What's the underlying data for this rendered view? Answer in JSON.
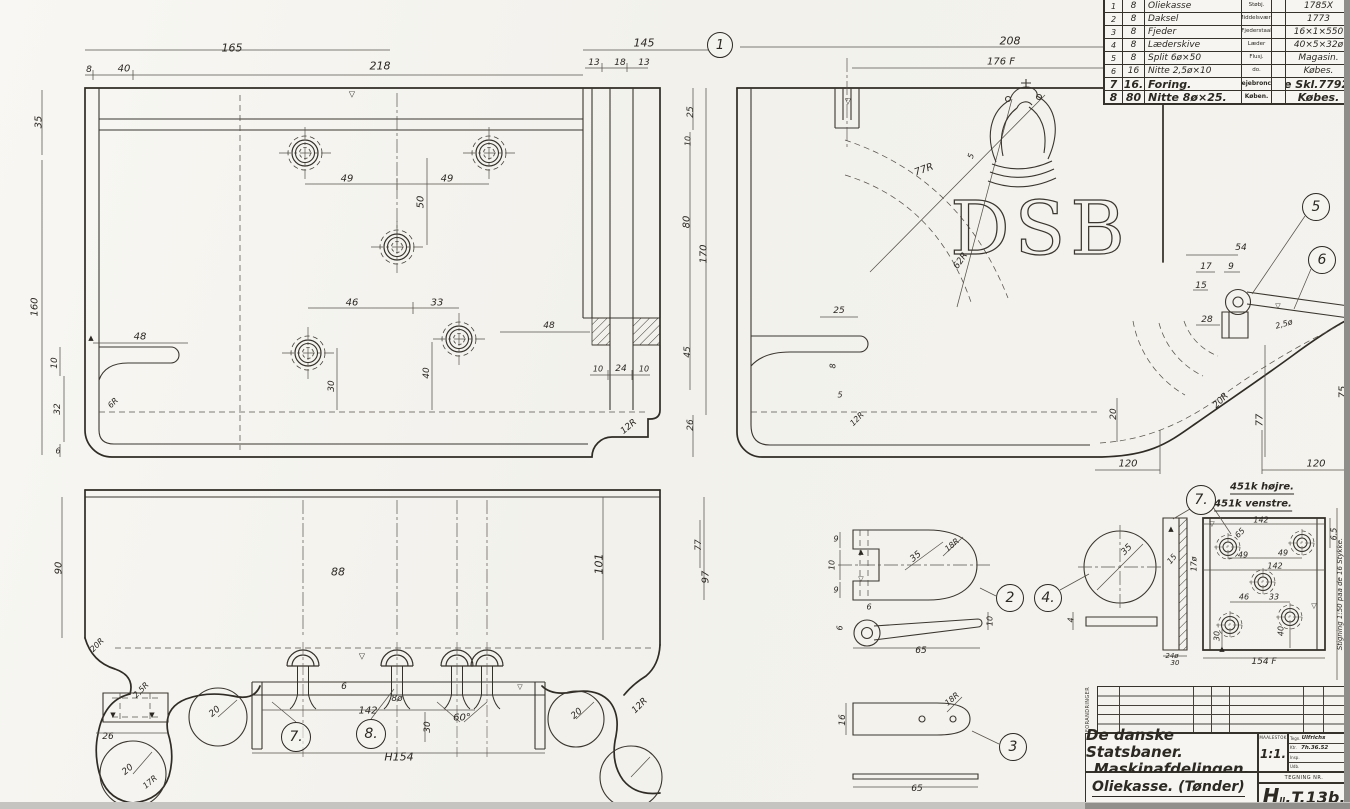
{
  "colors": {
    "ink": "#2c2923",
    "paper": "#f4f3ef",
    "scan_edge_right": "#8f8d89",
    "scan_edge_bottom": "#c6c4c0"
  },
  "emblem": {
    "letters": "DSB"
  },
  "parts_table": {
    "rows": [
      {
        "no": "1",
        "qty": "8",
        "name": "Oliekasse",
        "material": "Støbj.",
        "note": "1785X"
      },
      {
        "no": "2",
        "qty": "8",
        "name": "Daksel",
        "material": "Middelsvære",
        "note": "1773"
      },
      {
        "no": "3",
        "qty": "8",
        "name": "Fjeder",
        "material": "Fjederstaal",
        "note": "16×1×550"
      },
      {
        "no": "4",
        "qty": "8",
        "name": "Læderskive",
        "material": "Læder",
        "note": "40×5×32ø"
      },
      {
        "no": "5",
        "qty": "8",
        "name": "Split 6ø×50",
        "material": "Flusj.",
        "note": "Magasin."
      },
      {
        "no": "6",
        "qty": "16",
        "name": "Nitte 2,5ø×10",
        "material": "do.",
        "note": "Købes."
      },
      {
        "no": "7",
        "qty": "16.",
        "name": "Foring.",
        "material": "Lejebronce",
        "note": "Se Skl.77926."
      },
      {
        "no": "8",
        "qty": "80",
        "name": "Nitte 8ø×25.",
        "material": "Køben.",
        "note": "Købes."
      }
    ]
  },
  "title_block": {
    "revisions_label": "FORANDRINGER",
    "company_line1": "De danske Statsbaner.",
    "company_line2": "Maskinafdelingen.",
    "drawing_title": "Oliekasse.  (Tønder)",
    "drawing_subtitle": "12.86.b.F.",
    "scale_label": "MAALESTOK",
    "scale_value": "1:1.",
    "sign_rows": [
      {
        "label": "Tegn.",
        "value": "Ulfrichs"
      },
      {
        "label": "Ktr.",
        "value": "7h.36.52"
      },
      {
        "label": "Insp.",
        "value": ""
      },
      {
        "label": "Udb.",
        "value": ""
      }
    ],
    "number_label": "TEGNING NR.",
    "number_prefix": "H",
    "number_sub": "II",
    "number_rest": ".T.13b."
  },
  "callouts": [
    {
      "n": "1",
      "x": 720,
      "y": 45,
      "d": 26
    },
    {
      "n": "2",
      "x": 1010,
      "y": 598,
      "d": 28
    },
    {
      "n": "3",
      "x": 1013,
      "y": 747,
      "d": 28
    },
    {
      "n": "4.",
      "x": 1048,
      "y": 598,
      "d": 28
    },
    {
      "n": "5",
      "x": 1316,
      "y": 207,
      "d": 28
    },
    {
      "n": "6",
      "x": 1322,
      "y": 260,
      "d": 28
    },
    {
      "n": "7.",
      "x": 296,
      "y": 737,
      "d": 30
    },
    {
      "n": "8.",
      "x": 371,
      "y": 734,
      "d": 30
    },
    {
      "n": "7.",
      "x": 1201,
      "y": 500,
      "d": 30
    }
  ],
  "dim_labels": [
    {
      "t": "165",
      "x": 232,
      "y": 48,
      "s": 11
    },
    {
      "t": "8",
      "x": 89,
      "y": 70,
      "s": 9
    },
    {
      "t": "40",
      "x": 124,
      "y": 69
    },
    {
      "t": "218",
      "x": 380,
      "y": 66,
      "s": 11
    },
    {
      "t": "145",
      "x": 644,
      "y": 43,
      "s": 11
    },
    {
      "t": "13",
      "x": 594,
      "y": 63,
      "s": 9
    },
    {
      "t": "18",
      "x": 620,
      "y": 63,
      "s": 9
    },
    {
      "t": "13",
      "x": 644,
      "y": 63,
      "s": 9
    },
    {
      "t": "▽",
      "x": 352,
      "y": 94,
      "s": 8
    },
    {
      "t": "35",
      "x": 39,
      "y": 122,
      "r": -90
    },
    {
      "t": "160",
      "x": 35,
      "y": 307,
      "r": -90
    },
    {
      "t": "49",
      "x": 347,
      "y": 179
    },
    {
      "t": "49",
      "x": 447,
      "y": 179
    },
    {
      "t": "50",
      "x": 421,
      "y": 202,
      "r": -90
    },
    {
      "t": "46",
      "x": 352,
      "y": 303
    },
    {
      "t": "33",
      "x": 437,
      "y": 303
    },
    {
      "t": "30",
      "x": 332,
      "y": 386,
      "r": -90,
      "s": 9
    },
    {
      "t": "40",
      "x": 427,
      "y": 373,
      "r": -90,
      "s": 9
    },
    {
      "t": "▲",
      "x": 91,
      "y": 338,
      "s": 7
    },
    {
      "t": "48",
      "x": 140,
      "y": 337
    },
    {
      "t": "10",
      "x": 55,
      "y": 363,
      "r": -90,
      "s": 9
    },
    {
      "t": "32",
      "x": 58,
      "y": 409,
      "r": -90,
      "s": 9
    },
    {
      "t": "6",
      "x": 58,
      "y": 451,
      "s": 8
    },
    {
      "t": "6R",
      "x": 113,
      "y": 403,
      "r": -45,
      "s": 8
    },
    {
      "t": "48",
      "x": 549,
      "y": 326,
      "s": 9
    },
    {
      "t": "10",
      "x": 598,
      "y": 369,
      "s": 8
    },
    {
      "t": "24",
      "x": 621,
      "y": 369,
      "s": 9
    },
    {
      "t": "10",
      "x": 644,
      "y": 369,
      "s": 8
    },
    {
      "t": "12R",
      "x": 629,
      "y": 427,
      "r": -40,
      "s": 9
    },
    {
      "t": "25",
      "x": 691,
      "y": 112,
      "r": -90,
      "s": 9
    },
    {
      "t": "10",
      "x": 688,
      "y": 141,
      "r": -90,
      "s": 8
    },
    {
      "t": "80",
      "x": 687,
      "y": 222,
      "r": -90
    },
    {
      "t": "170",
      "x": 704,
      "y": 254,
      "r": -90
    },
    {
      "t": "45",
      "x": 688,
      "y": 352,
      "r": -90,
      "s": 9
    },
    {
      "t": "26",
      "x": 691,
      "y": 425,
      "r": -90,
      "s": 9
    },
    {
      "t": "208",
      "x": 1010,
      "y": 41,
      "s": 11
    },
    {
      "t": "176 F",
      "x": 1001,
      "y": 62
    },
    {
      "t": "▽",
      "x": 848,
      "y": 101,
      "s": 8
    },
    {
      "t": "77R",
      "x": 924,
      "y": 170,
      "r": -20
    },
    {
      "t": "5",
      "x": 971,
      "y": 156,
      "r": -70,
      "s": 8
    },
    {
      "t": "62R",
      "x": 961,
      "y": 261,
      "r": -55,
      "s": 9
    },
    {
      "t": "25",
      "x": 839,
      "y": 311,
      "s": 9
    },
    {
      "t": "8",
      "x": 833,
      "y": 366,
      "r": -90,
      "s": 8
    },
    {
      "t": "5",
      "x": 840,
      "y": 395,
      "s": 8
    },
    {
      "t": "12R",
      "x": 857,
      "y": 419,
      "r": -45,
      "s": 8
    },
    {
      "t": "54",
      "x": 1241,
      "y": 248,
      "s": 9
    },
    {
      "t": "17",
      "x": 1206,
      "y": 267,
      "s": 9
    },
    {
      "t": "9",
      "x": 1231,
      "y": 267,
      "s": 9
    },
    {
      "t": "15",
      "x": 1201,
      "y": 286,
      "s": 9
    },
    {
      "t": "28",
      "x": 1207,
      "y": 320,
      "s": 9
    },
    {
      "t": "▽",
      "x": 1278,
      "y": 306,
      "s": 7
    },
    {
      "t": "2,5ø",
      "x": 1284,
      "y": 324,
      "r": -15,
      "s": 8
    },
    {
      "t": "20",
      "x": 1114,
      "y": 414,
      "r": -90,
      "s": 9
    },
    {
      "t": "20R",
      "x": 1221,
      "y": 401,
      "r": -45,
      "s": 9
    },
    {
      "t": "77",
      "x": 1260,
      "y": 420,
      "r": -90
    },
    {
      "t": "75",
      "x": 1343,
      "y": 392,
      "r": -90
    },
    {
      "t": "120",
      "x": 1128,
      "y": 464
    },
    {
      "t": "120",
      "x": 1316,
      "y": 464
    },
    {
      "t": "88",
      "x": 338,
      "y": 572,
      "s": 11
    },
    {
      "t": "101",
      "x": 599,
      "y": 564,
      "r": -90,
      "s": 11
    },
    {
      "t": "90",
      "x": 59,
      "y": 568,
      "r": -90
    },
    {
      "t": "97",
      "x": 706,
      "y": 577,
      "r": -90
    },
    {
      "t": "77",
      "x": 699,
      "y": 545,
      "r": -90,
      "s": 9
    },
    {
      "t": "20R",
      "x": 97,
      "y": 645,
      "r": -45,
      "s": 8
    },
    {
      "t": "▼",
      "x": 113,
      "y": 715,
      "s": 7
    },
    {
      "t": "▼",
      "x": 152,
      "y": 715,
      "s": 7
    },
    {
      "t": "26",
      "x": 108,
      "y": 737,
      "s": 9
    },
    {
      "t": "2,5R",
      "x": 141,
      "y": 690,
      "r": -45,
      "s": 8
    },
    {
      "t": "20",
      "x": 128,
      "y": 770,
      "r": -40,
      "s": 9
    },
    {
      "t": "17R",
      "x": 150,
      "y": 782,
      "r": -40,
      "s": 8
    },
    {
      "t": "20",
      "x": 215,
      "y": 712,
      "r": -40,
      "s": 9
    },
    {
      "t": "20",
      "x": 577,
      "y": 714,
      "r": -40,
      "s": 9
    },
    {
      "t": "12R",
      "x": 640,
      "y": 706,
      "r": -45,
      "s": 9
    },
    {
      "t": "▽",
      "x": 362,
      "y": 656,
      "s": 8
    },
    {
      "t": "▽",
      "x": 520,
      "y": 687,
      "s": 7
    },
    {
      "t": "6",
      "x": 344,
      "y": 687,
      "s": 9
    },
    {
      "t": "8ø",
      "x": 397,
      "y": 699,
      "s": 9
    },
    {
      "t": "142",
      "x": 368,
      "y": 711
    },
    {
      "t": "60°",
      "x": 462,
      "y": 718
    },
    {
      "t": "30",
      "x": 428,
      "y": 727,
      "r": -90,
      "s": 9
    },
    {
      "t": "H154",
      "x": 399,
      "y": 757,
      "s": 11
    },
    {
      "t": "9",
      "x": 836,
      "y": 539,
      "s": 8
    },
    {
      "t": "10",
      "x": 832,
      "y": 565,
      "r": -90,
      "s": 8
    },
    {
      "t": "9",
      "x": 836,
      "y": 590,
      "s": 8
    },
    {
      "t": "▲",
      "x": 861,
      "y": 552,
      "s": 7
    },
    {
      "t": "▽",
      "x": 861,
      "y": 579,
      "s": 7
    },
    {
      "t": "35",
      "x": 916,
      "y": 557,
      "r": -40,
      "s": 9
    },
    {
      "t": "18R",
      "x": 952,
      "y": 545,
      "r": -40,
      "s": 8
    },
    {
      "t": "6",
      "x": 869,
      "y": 607,
      "s": 8
    },
    {
      "t": "6",
      "x": 840,
      "y": 628,
      "r": -90,
      "s": 8
    },
    {
      "t": "65",
      "x": 921,
      "y": 651,
      "s": 9
    },
    {
      "t": "10",
      "x": 990,
      "y": 621,
      "r": -90,
      "s": 8
    },
    {
      "t": "35",
      "x": 1127,
      "y": 550,
      "r": -45,
      "s": 9
    },
    {
      "t": "4",
      "x": 1071,
      "y": 620,
      "r": -90,
      "s": 8
    },
    {
      "t": "18R",
      "x": 952,
      "y": 699,
      "r": -40,
      "s": 8
    },
    {
      "t": "16",
      "x": 843,
      "y": 720,
      "r": -90,
      "s": 9
    },
    {
      "t": "65",
      "x": 917,
      "y": 789,
      "s": 9
    },
    {
      "t": "451k højre.",
      "x": 1262,
      "y": 488,
      "s": 10,
      "c": "hand-u"
    },
    {
      "t": "451k venstre.",
      "x": 1253,
      "y": 505,
      "s": 10,
      "c": "hand-u"
    },
    {
      "t": "142",
      "x": 1261,
      "y": 520,
      "s": 8
    },
    {
      "t": "65",
      "x": 1240,
      "y": 533,
      "r": -45,
      "s": 8
    },
    {
      "t": "6.5",
      "x": 1334,
      "y": 534,
      "r": -90,
      "s": 8
    },
    {
      "t": "49",
      "x": 1243,
      "y": 555,
      "s": 8
    },
    {
      "t": "49",
      "x": 1283,
      "y": 553,
      "s": 8
    },
    {
      "t": "142",
      "x": 1275,
      "y": 566,
      "s": 8
    },
    {
      "t": "46",
      "x": 1244,
      "y": 597,
      "s": 8
    },
    {
      "t": "33",
      "x": 1274,
      "y": 597,
      "s": 8
    },
    {
      "t": "40",
      "x": 1281,
      "y": 631,
      "r": -90,
      "s": 8
    },
    {
      "t": "30",
      "x": 1217,
      "y": 636,
      "r": -90,
      "s": 8
    },
    {
      "t": "154 F",
      "x": 1264,
      "y": 662,
      "s": 9
    },
    {
      "t": "15",
      "x": 1172,
      "y": 559,
      "r": -50,
      "s": 8
    },
    {
      "t": "17ø",
      "x": 1194,
      "y": 564,
      "r": -90,
      "s": 8
    },
    {
      "t": "24ø",
      "x": 1172,
      "y": 656,
      "s": 7
    },
    {
      "t": "30",
      "x": 1175,
      "y": 663,
      "s": 7
    },
    {
      "t": "▽",
      "x": 1212,
      "y": 524,
      "s": 7
    },
    {
      "t": "▲",
      "x": 1222,
      "y": 649,
      "s": 7
    },
    {
      "t": "▽",
      "x": 1314,
      "y": 606,
      "s": 7
    },
    {
      "t": "▲",
      "x": 1171,
      "y": 529,
      "s": 7
    },
    {
      "t": "Stigning 1:50 paa de 16 Stykke.",
      "x": 1340,
      "y": 594,
      "r": -90,
      "s": 7
    }
  ]
}
